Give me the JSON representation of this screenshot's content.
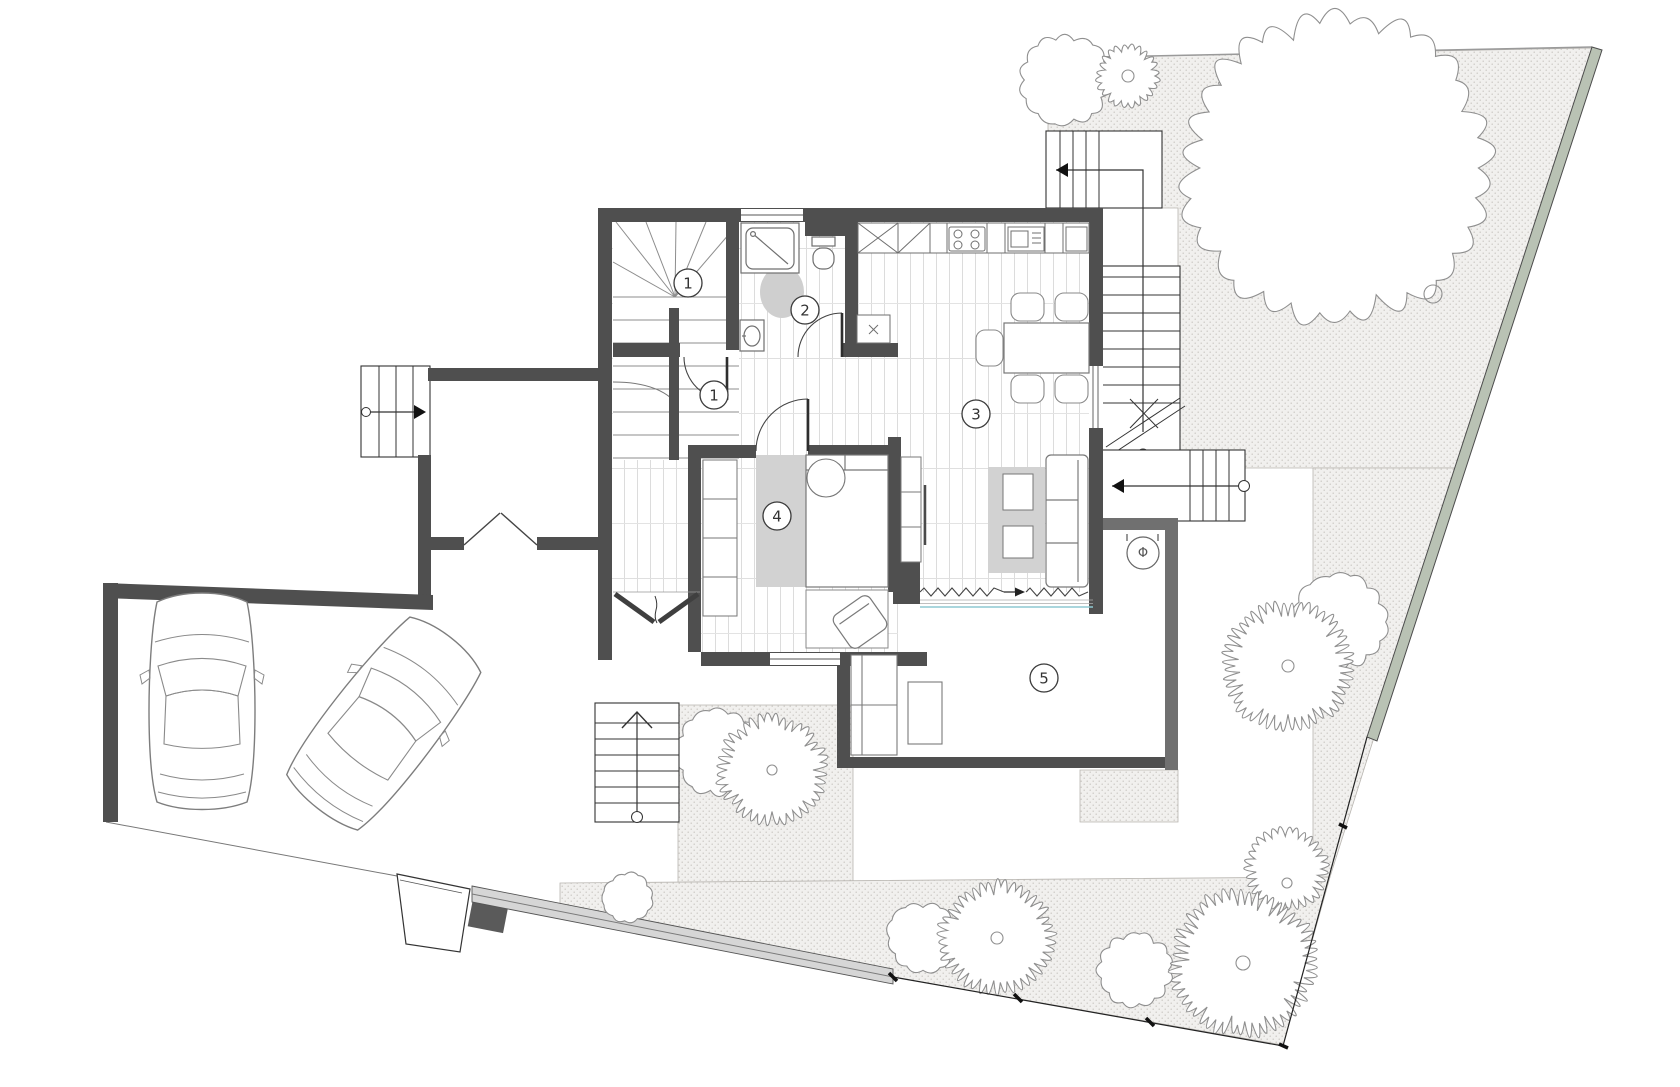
{
  "drawing": {
    "title": "ground-floor-site-plan",
    "room_labels": [
      {
        "id": "room-label-1-stair",
        "text": "1",
        "x": 688,
        "y": 283
      },
      {
        "id": "room-label-1-hall",
        "text": "1",
        "x": 714,
        "y": 395
      },
      {
        "id": "room-label-2-bath",
        "text": "2",
        "x": 805,
        "y": 310
      },
      {
        "id": "room-label-3-living",
        "text": "3",
        "x": 976,
        "y": 414
      },
      {
        "id": "room-label-4-bedroom",
        "text": "4",
        "x": 777,
        "y": 516
      },
      {
        "id": "room-label-5-terrace",
        "text": "5",
        "x": 1044,
        "y": 678
      }
    ],
    "symbols": [
      {
        "id": "column-marker",
        "text": "Φ",
        "x": 1143,
        "y": 553
      }
    ],
    "counts": {
      "cars": 2,
      "trees": 15,
      "exterior_stairs": 4,
      "interior_stairs": 1
    },
    "colors": {
      "wall": "#4f4f4f",
      "wall_light": "#707070",
      "fence": "#b9c2b4",
      "floor_line": "#dcdcdc",
      "rug": "#d2d2d2",
      "stipple_bg": "#f1f0ee",
      "stipple_dot": "#c8c5c0",
      "glazing": "#8ec8d2",
      "path": "#d6d6d6",
      "line": "#333333",
      "tree_line": "#8f8f8f"
    }
  }
}
